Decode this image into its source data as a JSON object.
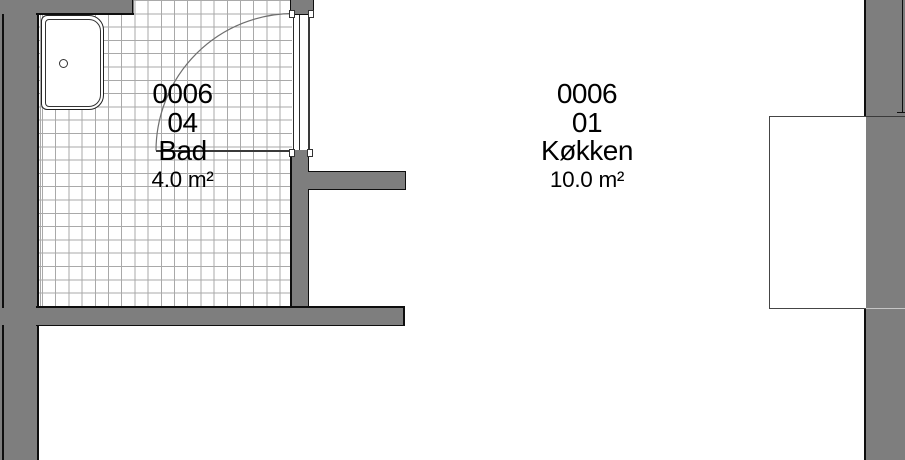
{
  "rooms": [
    {
      "unit": "0006",
      "room_number": "04",
      "name": "Bad",
      "area": "4.0 m²"
    },
    {
      "unit": "0006",
      "room_number": "01",
      "name": "Køkken",
      "area": "10.0 m²"
    }
  ],
  "colors": {
    "wall": "#7e7e7e",
    "outline": "#0e0e0e",
    "tile_line": "#a9a9a9",
    "background": "#ffffff"
  }
}
